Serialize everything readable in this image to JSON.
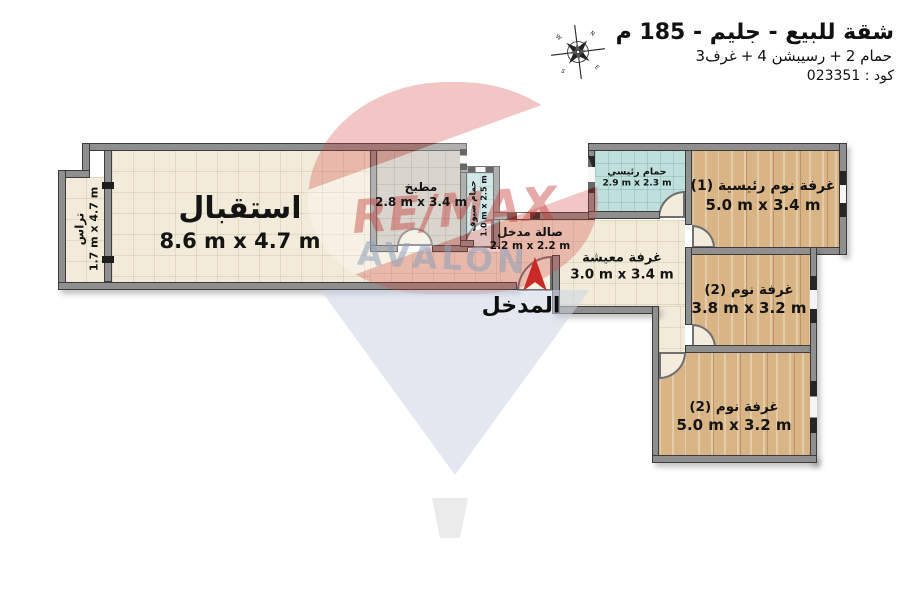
{
  "header": {
    "title": "شقة للبيع - جليم - 185 م",
    "subtitle_parts": [
      "3غرف",
      "+",
      "4 رسيبشن",
      "+",
      "2 حمام"
    ],
    "code": "كود : 023351",
    "compass": {
      "n": "N",
      "e": "E",
      "s": "S",
      "w": "W"
    }
  },
  "rooms": {
    "reception": {
      "name": "استقبال",
      "dims": "8.6 m x 4.7 m"
    },
    "terrace": {
      "name": "تراس",
      "dims": "1.7 m x 4.7 m"
    },
    "kitchen": {
      "name": "مطبخ",
      "dims": "2.8 m x 3.4 m"
    },
    "guest_bath": {
      "name": "حمام ضيوف",
      "dims": "1.0 m x 2.5 m"
    },
    "entry_hall": {
      "name": "صالة مدخل",
      "dims": "2.2 m x 2.2 m"
    },
    "living": {
      "name": "غرفة معيشة",
      "dims": "3.0 m x 3.4 m"
    },
    "main_bath": {
      "name": "حمام رئيسي",
      "dims": "2.9 m x 2.3 m"
    },
    "master_bedroom": {
      "name": "غرفة نوم رئيسية (1)",
      "dims": "5.0 m x 3.4 m"
    },
    "bedroom_2": {
      "name": "غرفة نوم (2)",
      "dims": "3.8 m x 3.2 m"
    },
    "bedroom_3": {
      "name": "غرفة نوم (2)",
      "dims": "5.0 m x 3.2 m"
    }
  },
  "entrance": {
    "label": "المدخل"
  },
  "watermark": {
    "brand": "RE/MAX",
    "name": "AVALON"
  },
  "colors": {
    "wall": "#8f8f8f",
    "tile_floor": "#f2ebd9",
    "kitchen_floor": "#c9c1b7",
    "bath_floor": "#bedfdc",
    "wood_floor": "#d9b586",
    "entrance_arrow": "#c92a28",
    "watermark_red": "#c63a35",
    "watermark_blue": "#8ea1ba"
  }
}
